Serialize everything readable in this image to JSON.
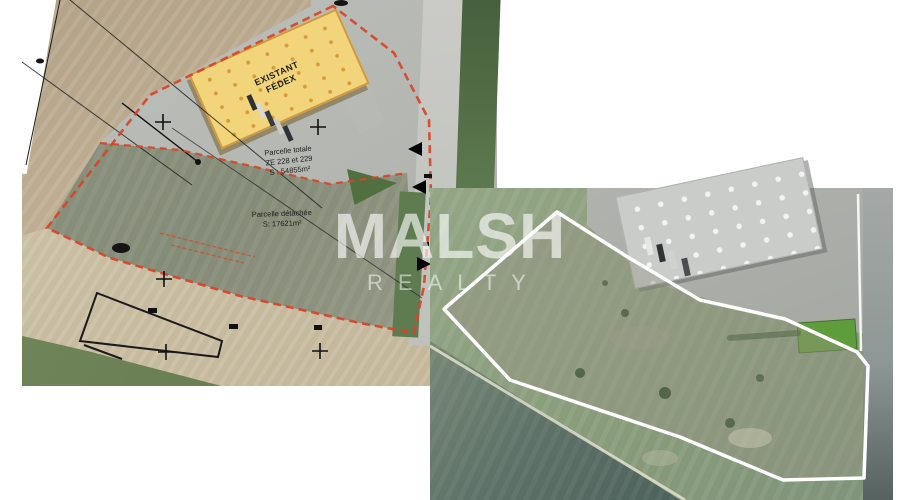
{
  "watermark": {
    "line1": "MALSH",
    "line2": "REALTY"
  },
  "left_map": {
    "building": {
      "line1": "EXISTANT",
      "line2": "FÉDEX"
    },
    "total_parcel_note": {
      "line1": "Parcelle totale",
      "line2": "ZE 228 et 229",
      "line3": "S : 54855m²"
    },
    "detached_parcel_note": {
      "line1": "Parcelle détachée",
      "line2": "S: 17621m²"
    },
    "boundary_color": "#d84327"
  },
  "right_map": {
    "boundary_color": "#ffffff"
  }
}
